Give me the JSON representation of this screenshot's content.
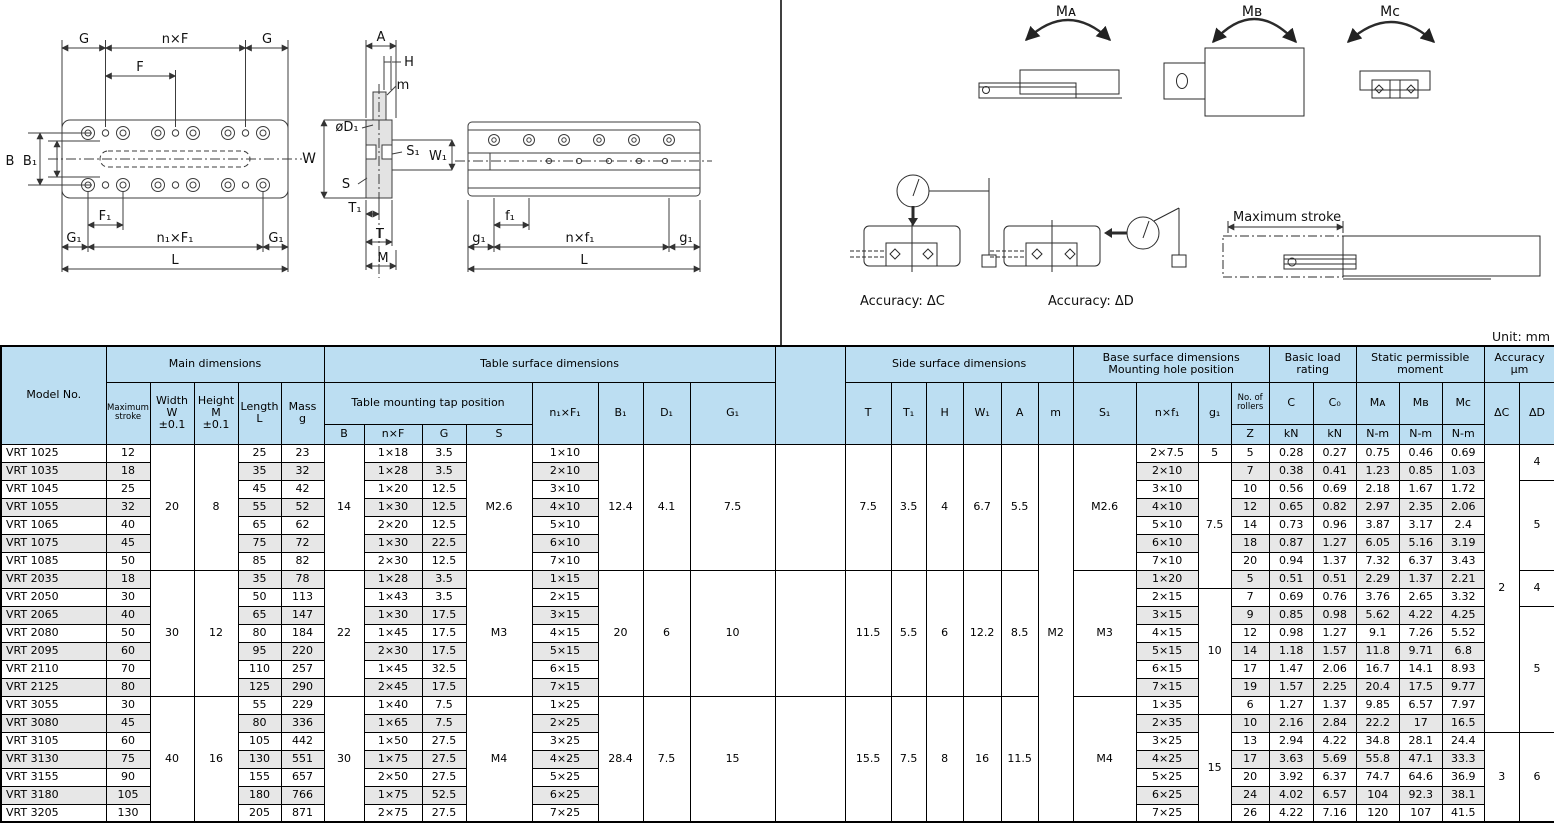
{
  "unit_label": "Unit: mm",
  "drawings": {
    "labels": {
      "plan": {
        "g_left": "G",
        "nxf": "n×F",
        "g_right": "G",
        "f": "F",
        "b": "B",
        "b1": "B₁",
        "f1": "F₁",
        "g1_left": "G₁",
        "n1xf1": "n₁×F₁",
        "g1_right": "G₁",
        "l": "L"
      },
      "section": {
        "a": "A",
        "h": "H",
        "m": "m",
        "d1": "øD₁",
        "w": "W",
        "s1": "S₁",
        "w1": "W₁",
        "s": "S",
        "t1": "T₁",
        "t": "T",
        "m_bottom": "M"
      },
      "elevation": {
        "f1": "f₁",
        "g1_left": "g₁",
        "nxf1": "n×f₁",
        "g1_right": "g₁",
        "l": "L"
      },
      "moments": {
        "ma": "Mᴀ",
        "mb": "Mʙ",
        "mc": "Mᴄ"
      },
      "accuracy": {
        "dc": "Accuracy: ΔC",
        "dd": "Accuracy: ΔD",
        "max_stroke": "Maximum stroke"
      }
    }
  },
  "table": {
    "row_count": 21,
    "header": [
      [
        {
          "t": "Model No.",
          "rs": 3
        },
        {
          "t": "Main dimensions",
          "cs": 5
        },
        {
          "t": "Table surface dimensions",
          "cs": 8
        },
        {
          "t": "",
          "rs": 3
        },
        {
          "t": "Side surface dimensions",
          "cs": 6
        },
        {
          "t": "Base surface dimensions\nMounting hole position",
          "cs": 4
        },
        {
          "t": "Basic load\nrating",
          "cs": 2
        },
        {
          "t": "Static permissible\nmoment",
          "cs": 3
        },
        {
          "t": "Accuracy\nµm",
          "cs": 2
        }
      ],
      [
        {
          "t": "Maximum\nstroke",
          "rs": 2,
          "cls": "xs"
        },
        {
          "t": "Width\nW\n±0.1",
          "rs": 2
        },
        {
          "t": "Height\nM\n±0.1",
          "rs": 2
        },
        {
          "t": "Length\nL",
          "rs": 2
        },
        {
          "t": "Mass\ng",
          "rs": 2
        },
        {
          "t": "Table mounting tap position",
          "cs": 4
        },
        {
          "t": "n₁×F₁",
          "rs": 2
        },
        {
          "t": "B₁",
          "rs": 2
        },
        {
          "t": "D₁",
          "rs": 2
        },
        {
          "t": "G₁",
          "rs": 2
        },
        {
          "t": "T",
          "rs": 2
        },
        {
          "t": "T₁",
          "rs": 2
        },
        {
          "t": "H",
          "rs": 2
        },
        {
          "t": "W₁",
          "rs": 2
        },
        {
          "t": "A",
          "rs": 2
        },
        {
          "t": "m",
          "rs": 2
        },
        {
          "t": "S₁",
          "rs": 2
        },
        {
          "t": "n×f₁",
          "rs": 2
        },
        {
          "t": "g₁",
          "rs": 2
        },
        {
          "t": "No. of\nrollers",
          "cls": "xs"
        },
        {
          "t": "C"
        },
        {
          "t": "C₀"
        },
        {
          "t": "Mᴀ"
        },
        {
          "t": "Mʙ"
        },
        {
          "t": "Mᴄ"
        },
        {
          "t": "ΔC",
          "rs": 2
        },
        {
          "t": "ΔD",
          "rs": 2
        }
      ],
      [
        {
          "t": "B"
        },
        {
          "t": "n×F"
        },
        {
          "t": "G"
        },
        {
          "t": "S"
        },
        {
          "t": "Z"
        },
        {
          "t": "kN"
        },
        {
          "t": "kN"
        },
        {
          "t": "N-m"
        },
        {
          "t": "N-m"
        },
        {
          "t": "N-m"
        }
      ]
    ],
    "columns": [
      {
        "key": "model",
        "values": [
          "VRT 1025",
          "VRT 1035",
          "VRT 1045",
          "VRT 1055",
          "VRT 1065",
          "VRT 1075",
          "VRT 1085",
          "VRT 2035",
          "VRT 2050",
          "VRT 2065",
          "VRT 2080",
          "VRT 2095",
          "VRT 2110",
          "VRT 2125",
          "VRT 3055",
          "VRT 3080",
          "VRT 3105",
          "VRT 3130",
          "VRT 3155",
          "VRT 3180",
          "VRT 3205"
        ]
      },
      {
        "key": "stroke",
        "values": [
          "12",
          "18",
          "25",
          "32",
          "40",
          "45",
          "50",
          "18",
          "30",
          "40",
          "50",
          "60",
          "70",
          "80",
          "30",
          "45",
          "60",
          "75",
          "90",
          "105",
          "130"
        ]
      },
      {
        "key": "width",
        "merged": [
          [
            0,
            7,
            "20"
          ],
          [
            7,
            7,
            "30"
          ],
          [
            14,
            7,
            "40"
          ]
        ]
      },
      {
        "key": "height",
        "merged": [
          [
            0,
            7,
            "8"
          ],
          [
            7,
            7,
            "12"
          ],
          [
            14,
            7,
            "16"
          ]
        ]
      },
      {
        "key": "length",
        "values": [
          "25",
          "35",
          "45",
          "55",
          "65",
          "75",
          "85",
          "35",
          "50",
          "65",
          "80",
          "95",
          "110",
          "125",
          "55",
          "80",
          "105",
          "130",
          "155",
          "180",
          "205"
        ]
      },
      {
        "key": "mass",
        "values": [
          "23",
          "32",
          "42",
          "52",
          "62",
          "72",
          "82",
          "78",
          "113",
          "147",
          "184",
          "220",
          "257",
          "290",
          "229",
          "336",
          "442",
          "551",
          "657",
          "766",
          "871"
        ]
      },
      {
        "key": "b",
        "merged": [
          [
            0,
            7,
            "14"
          ],
          [
            7,
            7,
            "22"
          ],
          [
            14,
            7,
            "30"
          ]
        ]
      },
      {
        "key": "nxF",
        "values": [
          "1×18",
          "1×28",
          "1×20",
          "1×30",
          "2×20",
          "1×30",
          "2×30",
          "1×28",
          "1×43",
          "1×30",
          "1×45",
          "2×30",
          "1×45",
          "2×45",
          "1×40",
          "1×65",
          "1×50",
          "1×75",
          "2×50",
          "1×75",
          "2×75"
        ]
      },
      {
        "key": "g",
        "values": [
          "3.5",
          "3.5",
          "12.5",
          "12.5",
          "12.5",
          "22.5",
          "12.5",
          "3.5",
          "3.5",
          "17.5",
          "17.5",
          "17.5",
          "32.5",
          "17.5",
          "7.5",
          "7.5",
          "27.5",
          "27.5",
          "27.5",
          "52.5",
          "27.5"
        ]
      },
      {
        "key": "s",
        "merged": [
          [
            0,
            7,
            "M2.6"
          ],
          [
            7,
            7,
            "M3"
          ],
          [
            14,
            7,
            "M4"
          ]
        ]
      },
      {
        "key": "n1xF1",
        "values": [
          "1×10",
          "2×10",
          "3×10",
          "4×10",
          "5×10",
          "6×10",
          "7×10",
          "1×15",
          "2×15",
          "3×15",
          "4×15",
          "5×15",
          "6×15",
          "7×15",
          "1×25",
          "2×25",
          "3×25",
          "4×25",
          "5×25",
          "6×25",
          "7×25"
        ]
      },
      {
        "key": "b1",
        "merged": [
          [
            0,
            7,
            "12.4"
          ],
          [
            7,
            7,
            "20"
          ],
          [
            14,
            7,
            "28.4"
          ]
        ]
      },
      {
        "key": "d1",
        "merged": [
          [
            0,
            7,
            "4.1"
          ],
          [
            7,
            7,
            "6"
          ],
          [
            14,
            7,
            "7.5"
          ]
        ]
      },
      {
        "key": "g1cap",
        "merged": [
          [
            0,
            7,
            "7.5"
          ],
          [
            7,
            7,
            "10"
          ],
          [
            14,
            7,
            "15"
          ]
        ]
      },
      {
        "key": "spacer",
        "merged": [
          [
            0,
            7,
            ""
          ],
          [
            7,
            7,
            ""
          ],
          [
            14,
            7,
            ""
          ]
        ]
      },
      {
        "key": "t",
        "merged": [
          [
            0,
            7,
            "7.5"
          ],
          [
            7,
            7,
            "11.5"
          ],
          [
            14,
            7,
            "15.5"
          ]
        ]
      },
      {
        "key": "t1",
        "merged": [
          [
            0,
            7,
            "3.5"
          ],
          [
            7,
            7,
            "5.5"
          ],
          [
            14,
            7,
            "7.5"
          ]
        ]
      },
      {
        "key": "h",
        "merged": [
          [
            0,
            7,
            "4"
          ],
          [
            7,
            7,
            "6"
          ],
          [
            14,
            7,
            "8"
          ]
        ]
      },
      {
        "key": "w1",
        "merged": [
          [
            0,
            7,
            "6.7"
          ],
          [
            7,
            7,
            "12.2"
          ],
          [
            14,
            7,
            "16"
          ]
        ]
      },
      {
        "key": "a",
        "merged": [
          [
            0,
            7,
            "5.5"
          ],
          [
            7,
            7,
            "8.5"
          ],
          [
            14,
            7,
            "11.5"
          ]
        ]
      },
      {
        "key": "m",
        "merged": [
          [
            0,
            21,
            "M2"
          ]
        ]
      },
      {
        "key": "s1",
        "merged": [
          [
            0,
            7,
            "M2.6"
          ],
          [
            7,
            7,
            "M3"
          ],
          [
            14,
            7,
            "M4"
          ]
        ]
      },
      {
        "key": "nxf1",
        "values": [
          "2×7.5",
          "2×10",
          "3×10",
          "4×10",
          "5×10",
          "6×10",
          "7×10",
          "1×20",
          "2×15",
          "3×15",
          "4×15",
          "5×15",
          "6×15",
          "7×15",
          "1×35",
          "2×35",
          "3×25",
          "4×25",
          "5×25",
          "6×25",
          "7×25"
        ]
      },
      {
        "key": "g1",
        "merged": [
          [
            0,
            1,
            "5"
          ],
          [
            1,
            7,
            "7.5"
          ],
          [
            8,
            7,
            "10"
          ],
          [
            15,
            6,
            "15"
          ]
        ]
      },
      {
        "key": "z",
        "values": [
          "5",
          "7",
          "10",
          "12",
          "14",
          "18",
          "20",
          "5",
          "7",
          "9",
          "12",
          "14",
          "17",
          "19",
          "6",
          "10",
          "13",
          "17",
          "20",
          "24",
          "26"
        ]
      },
      {
        "key": "c",
        "values": [
          "0.28",
          "0.38",
          "0.56",
          "0.65",
          "0.73",
          "0.87",
          "0.94",
          "0.51",
          "0.69",
          "0.85",
          "0.98",
          "1.18",
          "1.47",
          "1.57",
          "1.27",
          "2.16",
          "2.94",
          "3.63",
          "3.92",
          "4.02",
          "4.22"
        ]
      },
      {
        "key": "c0",
        "values": [
          "0.27",
          "0.41",
          "0.69",
          "0.82",
          "0.96",
          "1.27",
          "1.37",
          "0.51",
          "0.76",
          "0.98",
          "1.27",
          "1.57",
          "2.06",
          "2.25",
          "1.37",
          "2.84",
          "4.22",
          "5.69",
          "6.37",
          "6.57",
          "7.16"
        ]
      },
      {
        "key": "ma",
        "values": [
          "0.75",
          "1.23",
          "2.18",
          "2.97",
          "3.87",
          "6.05",
          "7.32",
          "2.29",
          "3.76",
          "5.62",
          "9.1",
          "11.8",
          "16.7",
          "20.4",
          "9.85",
          "22.2",
          "34.8",
          "55.8",
          "74.7",
          "104",
          "120"
        ]
      },
      {
        "key": "mb",
        "values": [
          "0.46",
          "0.85",
          "1.67",
          "2.35",
          "3.17",
          "5.16",
          "6.37",
          "1.37",
          "2.65",
          "4.22",
          "7.26",
          "9.71",
          "14.1",
          "17.5",
          "6.57",
          "17",
          "28.1",
          "47.1",
          "64.6",
          "92.3",
          "107"
        ]
      },
      {
        "key": "mc",
        "values": [
          "0.69",
          "1.03",
          "1.72",
          "2.06",
          "2.4",
          "3.19",
          "3.43",
          "2.21",
          "3.32",
          "4.25",
          "5.52",
          "6.8",
          "8.93",
          "9.77",
          "7.97",
          "16.5",
          "24.4",
          "33.3",
          "36.9",
          "38.1",
          "41.5"
        ]
      },
      {
        "key": "dC",
        "merged": [
          [
            0,
            16,
            "2"
          ],
          [
            16,
            5,
            "3"
          ]
        ]
      },
      {
        "key": "dD",
        "merged": [
          [
            0,
            2,
            "4"
          ],
          [
            2,
            5,
            "5"
          ],
          [
            7,
            2,
            "4"
          ],
          [
            9,
            7,
            "5"
          ],
          [
            16,
            5,
            "6"
          ]
        ]
      }
    ]
  }
}
